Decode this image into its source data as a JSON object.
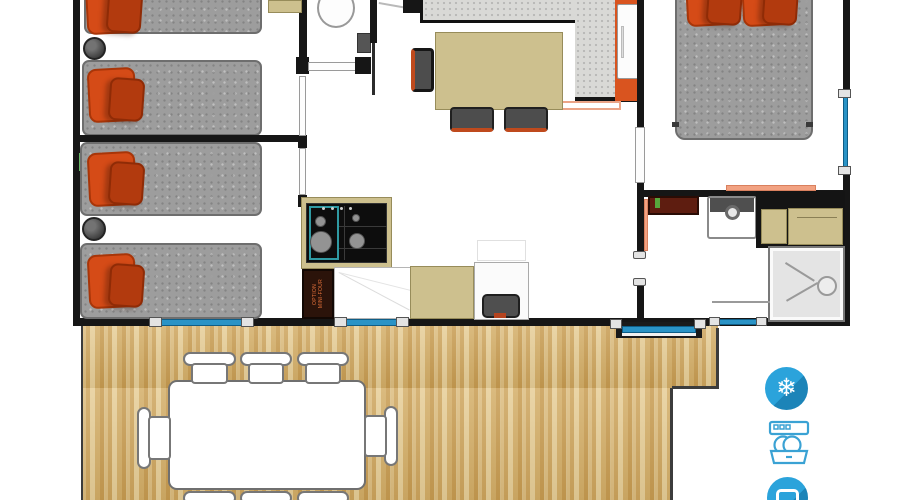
{
  "plan": {
    "type": "floor-plan",
    "option_label_line1": "OPTION",
    "option_label_line2": "MINI-FOUR",
    "rooms": [
      "bedroom-1",
      "bedroom-2",
      "wc",
      "living-kitchen",
      "master-bedroom",
      "bathroom",
      "terrace"
    ],
    "amenities": [
      {
        "name": "air-conditioning",
        "glyph": "❄"
      },
      {
        "name": "dishwasher"
      },
      {
        "name": "tv"
      }
    ],
    "colors": {
      "wall": "#161616",
      "mattress": "#9d9d9d",
      "pillow": "#d54b17",
      "pillow-dark": "#b23a0e",
      "tan": "#cdc08e",
      "tan-border": "#978c5a",
      "counter": "#d9d9d6",
      "window": "#2a93c6",
      "icon-blue": "#2ba3db",
      "icon-blue-dark": "#1c84b8",
      "wood": "#d7b272",
      "salmon": "#f2a282",
      "chair-red": "#bf4a1d",
      "deck-outline": "#3c3c3c"
    }
  }
}
